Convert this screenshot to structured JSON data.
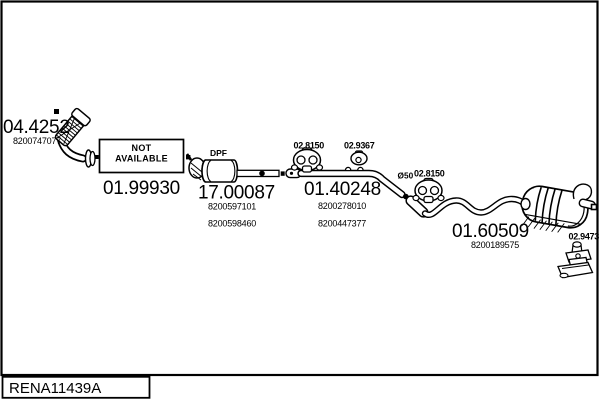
{
  "colors": {
    "ink": "#000000",
    "paper": "#ffffff"
  },
  "parts": [
    {
      "code": "04.4252",
      "refs": [
        "8200747077"
      ]
    },
    {
      "code": "01.99930",
      "availability": [
        "NOT",
        "AVAILABLE"
      ]
    },
    {
      "code": "17.00087",
      "tag": "DPF",
      "refs": [
        "8200597101",
        "8200598460"
      ]
    },
    {
      "code": "01.40248",
      "refs": [
        "8200278010",
        "8200447377"
      ],
      "diameter": "Ø50"
    },
    {
      "code": "01.60509",
      "refs": [
        "8200189575"
      ]
    }
  ],
  "accessories": [
    {
      "code": "02.8150",
      "type": "rubber-hanger"
    },
    {
      "code": "02.9367",
      "type": "rubber-mount"
    },
    {
      "code": "02.8150",
      "type": "rubber-hanger"
    },
    {
      "code": "02.9473",
      "type": "mounting-bracket"
    }
  ],
  "frame": {
    "drawing_code": "RENA11439A"
  }
}
